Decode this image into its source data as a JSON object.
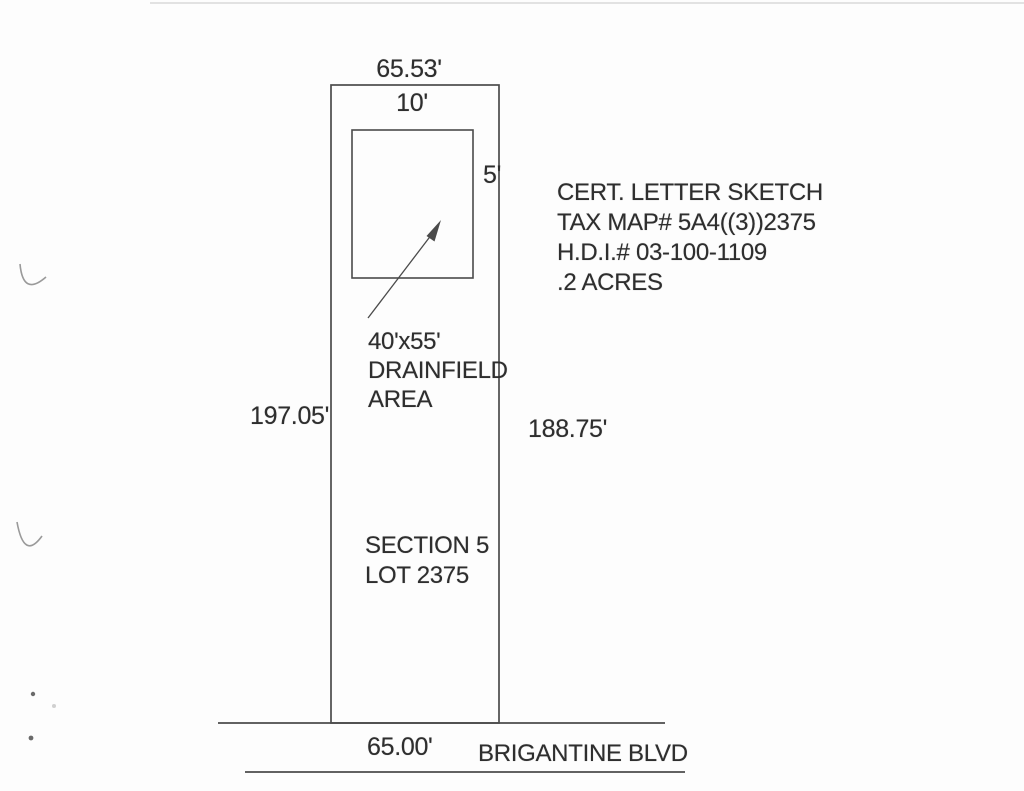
{
  "sketch": {
    "cert_block": {
      "line1": "CERT. LETTER SKETCH",
      "line2": "TAX MAP# 5A4((3))2375",
      "line3": "H.D.I.# 03-100-1109",
      "line4": ".2 ACRES"
    },
    "lot": {
      "front_width_top": "65.53'",
      "depth_left": "197.05'",
      "depth_right": "188.75'",
      "front_width_bottom": "65.00'",
      "section": "SECTION 5",
      "lot_number": "LOT 2375"
    },
    "drainfield": {
      "width": "10'",
      "height": "5'",
      "label_line1": "40'x55'",
      "label_line2": "DRAINFIELD",
      "label_line3": "AREA"
    },
    "road": {
      "name": "BRIGANTINE BLVD"
    }
  },
  "colors": {
    "ink": "#2e2e2e",
    "line": "#4b4b4b",
    "artifact": "#9a9a9a",
    "scan_edge": "#d9d9d9",
    "speck": "#6a6a6a"
  }
}
